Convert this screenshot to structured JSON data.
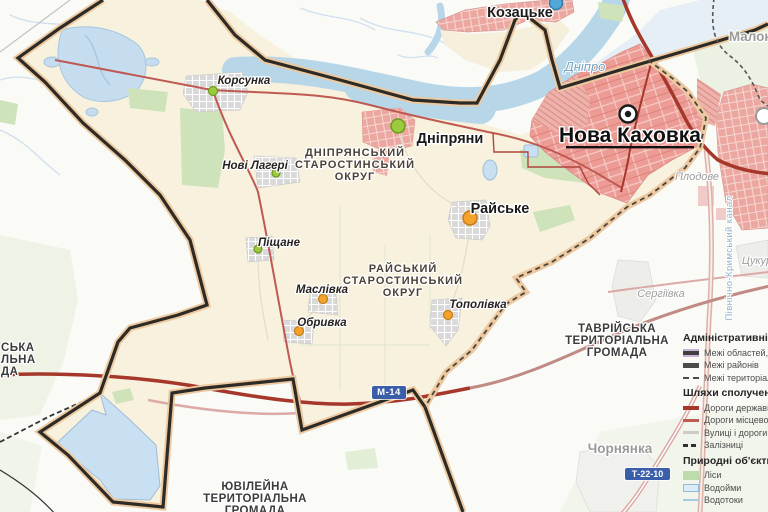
{
  "map": {
    "labels": {
      "nova_kakhovka": "Нова Каховка",
      "kozatske": "Козацьке",
      "dnipriany": "Дніпряни",
      "korsunka": "Корсунка",
      "novi_laheri": "Нові Лагері",
      "pishchane": "Піщане",
      "maslivka": "Маслівка",
      "obryvka": "Обривка",
      "raiske": "Райське",
      "topolivka": "Тополівка",
      "serhiivka": "Сергіївка",
      "plodove": "Плодове",
      "chornianka": "Чорнянка",
      "tsukury_clipped": "Цукур",
      "malokakhovka_clipped": "Малок",
      "dnipro_river": "Дніпро",
      "canal": "Північно-Кримський канал"
    },
    "districts": {
      "dnipriansky_lines": [
        "ДНІПРЯНСЬКИЙ",
        "СТАРОСТИНСЬКИЙ",
        "ОКРУГ"
      ],
      "raisky_lines": [
        "РАЙСЬКИЙ",
        "СТАРОСТИНСЬКИЙ",
        "ОКРУГ"
      ]
    },
    "hromadas": {
      "tavriiska_lines": [
        "ТАВРІЙСЬКА",
        "ТЕРИТОРІАЛЬНА",
        "ГРОМАДА"
      ],
      "yuvileina_lines": [
        "ЮВІЛЕЙНА",
        "ТЕРИТОРІАЛЬНА",
        "ГРОМАДА"
      ],
      "west_clipped_lines": [
        "СЬКА",
        "ЛЬНА",
        "ДА"
      ]
    },
    "road_badges": {
      "m14": "М-14",
      "t22_10": "Т-22-10"
    }
  },
  "legend": {
    "sections": [
      {
        "title": "Адміністративні межі:",
        "items": [
          {
            "label": "Межі областей, АРК"
          },
          {
            "label": "Межі районів"
          },
          {
            "label": "Межі територіальних громад"
          }
        ]
      },
      {
        "title": "Шляхи сполучення:",
        "items": [
          {
            "label": "Дороги державного значення"
          },
          {
            "label": "Дороги місцевого значення"
          },
          {
            "label": "Вулиці і дороги населених пунктів"
          },
          {
            "label": "Залізниці"
          }
        ]
      },
      {
        "title": "Природні об'єкти:",
        "items": [
          {
            "label": "Ліси"
          },
          {
            "label": "Водойми"
          },
          {
            "label": "Водотоки"
          }
        ]
      }
    ]
  },
  "colors": {
    "state_road": "#a6372b",
    "local_road": "#bf5a52",
    "urban_fill": "#ec9b95",
    "hromada_fill": "#f8f1dd",
    "boundary_casing": "#ecc9a0",
    "water": "#b7d7e9",
    "forest": "#cfe3ba",
    "badge_blue": "#3a5ea9"
  }
}
